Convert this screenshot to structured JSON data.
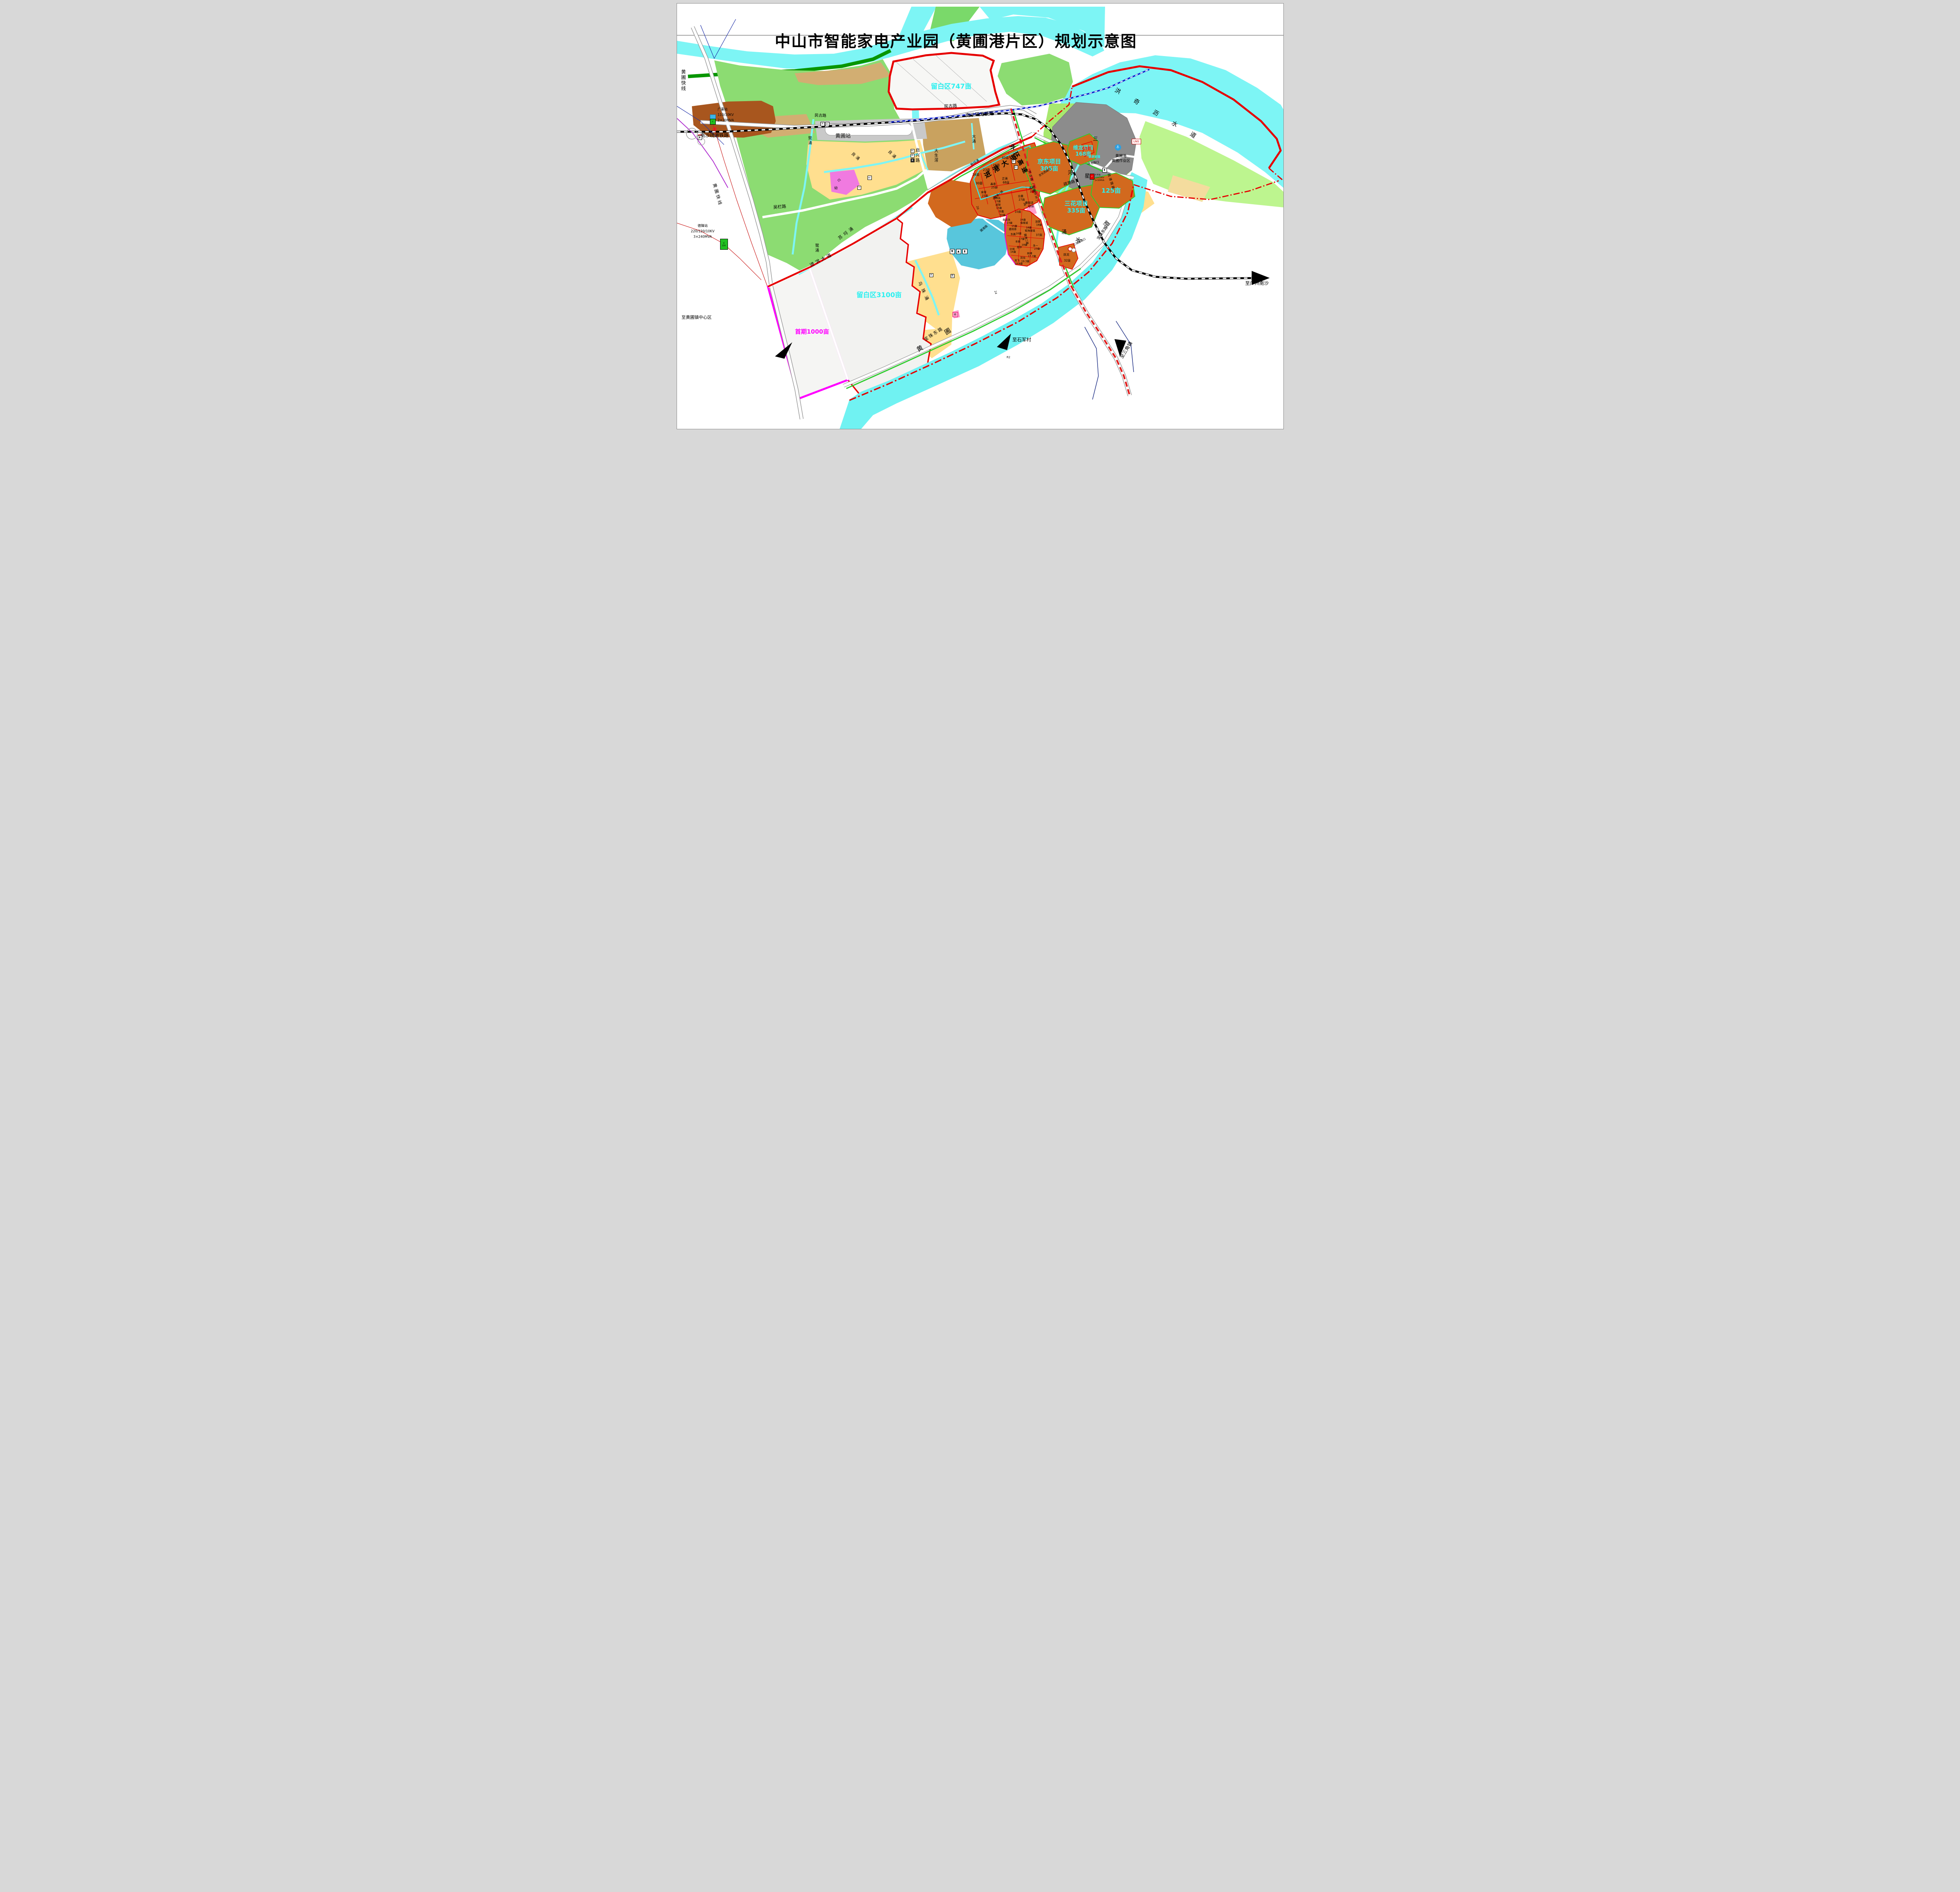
{
  "title": "中山市智能家电产业园（黄圃港片区）规划示意图",
  "zones": {
    "lb747": "留白区747亩",
    "lb3100": "留白区3100亩",
    "shouqi": "首期1000亩",
    "jd1": "京东项目",
    "jd2": "305亩",
    "wl1": "维龙项目",
    "wl2": "168亩",
    "sh1": "三花项目",
    "sh2": "335亩",
    "a125": "125亩",
    "a15": "15亩",
    "taiyuan": "泰源玻璃"
  },
  "port": {
    "l1": "黄圃港",
    "l2": "黄圃作业区",
    "lng": "LNG",
    "anchor": "⚓"
  },
  "stations": {
    "hp": "黄圃站",
    "gz": {
      "n": "广重站",
      "v": "110/10KV",
      "c": "2×20MVA",
      "b": "110"
    },
    "dl": {
      "n": "德隆站",
      "v": "220/120/10KV",
      "c": "3×240MVA",
      "b": "220"
    },
    "dc": {
      "n": "大岑站",
      "v": "110/10KV",
      "c": "3×50MVA"
    }
  },
  "roads": {
    "minggu": "民古路",
    "minggu2": "民古路",
    "nsr": "南沙疏港铁路",
    "nsr2": "南沙疏港铁路",
    "kuaixian": "黄圃快线",
    "kuaixian2": "黄圃快线",
    "wulan": "吴栏路",
    "wulan2": "吴栏路",
    "qixing": "启兴路",
    "jingang": "进港大道",
    "shugang": "疏港路",
    "shugangwei": "疏港围路",
    "waihuan": "外环高速",
    "mingudb": "民古路（东部外环）",
    "jinhong": "进洪大道",
    "baozhu1": "宝珠东路",
    "baozhu2": "宝珠东路",
    "pg1": "圃港一路",
    "pg2": "圃港二路",
    "pgr": "圃港路",
    "jdx": "京东西路口",
    "wlk": "维龙路口",
    "shx": "三花西路口"
  },
  "rivers": {
    "hq1": "洪",
    "hq2": "奇",
    "hq3": "沥",
    "hq4": "水",
    "hq5": "道",
    "hp1": "黄",
    "hp2": "圃",
    "hp3": "水",
    "hp4": "道",
    "sx1": "三",
    "sx2": "星",
    "sx3": "河",
    "sx4": "涌",
    "luyong": "鹭涌",
    "luyong2": "鹭涌",
    "liangyong": "良涌",
    "liangyong2": "良涌",
    "suleyong": "苏埒涌",
    "wuzhuyong": "乌珠涌",
    "xinleyong": "新埒涌",
    "dayong": "大涌",
    "dashengjiao": "大生滘"
  },
  "directions": {
    "zhongxin": "至黄圃镇中心区",
    "shijun": "至石军村",
    "sanjiao": "至三角镇",
    "nansha": "至广州南沙"
  },
  "parcelsA": [
    {
      "n": "40亩"
    },
    {
      "n": "28亩"
    },
    {
      "n": "23亩"
    },
    {
      "n": "16亩"
    },
    {
      "n": "30亩"
    },
    {
      "n": "晶泰",
      "a": "25亩"
    },
    {
      "n": "正美",
      "a": "68亩"
    },
    {
      "n": "金客",
      "a": "25亩"
    },
    {
      "n": "武林风",
      "a": "15亩"
    },
    {
      "n": "超智",
      "a": "15亩"
    },
    {
      "n": "华霸",
      "a": "30亩"
    },
    {
      "n": "立晨",
      "a": "27亩"
    },
    {
      "n": "鑫科",
      "a": "23亩"
    },
    {
      "n": "康丽洁",
      "a": "38亩"
    }
  ],
  "parcelsB": [
    {
      "n": "10亩"
    },
    {
      "n": "森法洛",
      "a": "23亩"
    },
    {
      "n": "16亩",
      "a": "佳维诚"
    },
    {
      "n": "浙萧",
      "a": "18亩"
    },
    {
      "n": "15亩",
      "a": "鑫铭泰"
    },
    {
      "n": "18亩",
      "a": "银海玻璃"
    },
    {
      "n": "东晨",
      "a": "16亩"
    },
    {
      "n": "37亩"
    },
    {
      "n": "丰鼎",
      "a": "17亩"
    },
    {
      "n": "旭华",
      "a": "18亩"
    },
    {
      "n": "永一",
      "a": "23亩"
    },
    {
      "n": "亿帆",
      "a": "16亩"
    },
    {
      "n": "林博",
      "a": "17.7亩"
    },
    {
      "n": "凯信",
      "a": "19.3亩"
    },
    {
      "n": "英飞",
      "a": "19.8亩"
    },
    {
      "n": "跃龙",
      "a": "32亩"
    }
  ],
  "roadnums": {
    "n20": "20",
    "n24": "24",
    "n36": "36",
    "r2": "R2"
  },
  "icons": {
    "p": "P",
    "wc": "WC",
    "huan": "环",
    "zai": "再",
    "you": "幼",
    "xiao": "小",
    "bolt": "⚡",
    "up": "▲",
    "down": "▼",
    "pump": "▮"
  }
}
